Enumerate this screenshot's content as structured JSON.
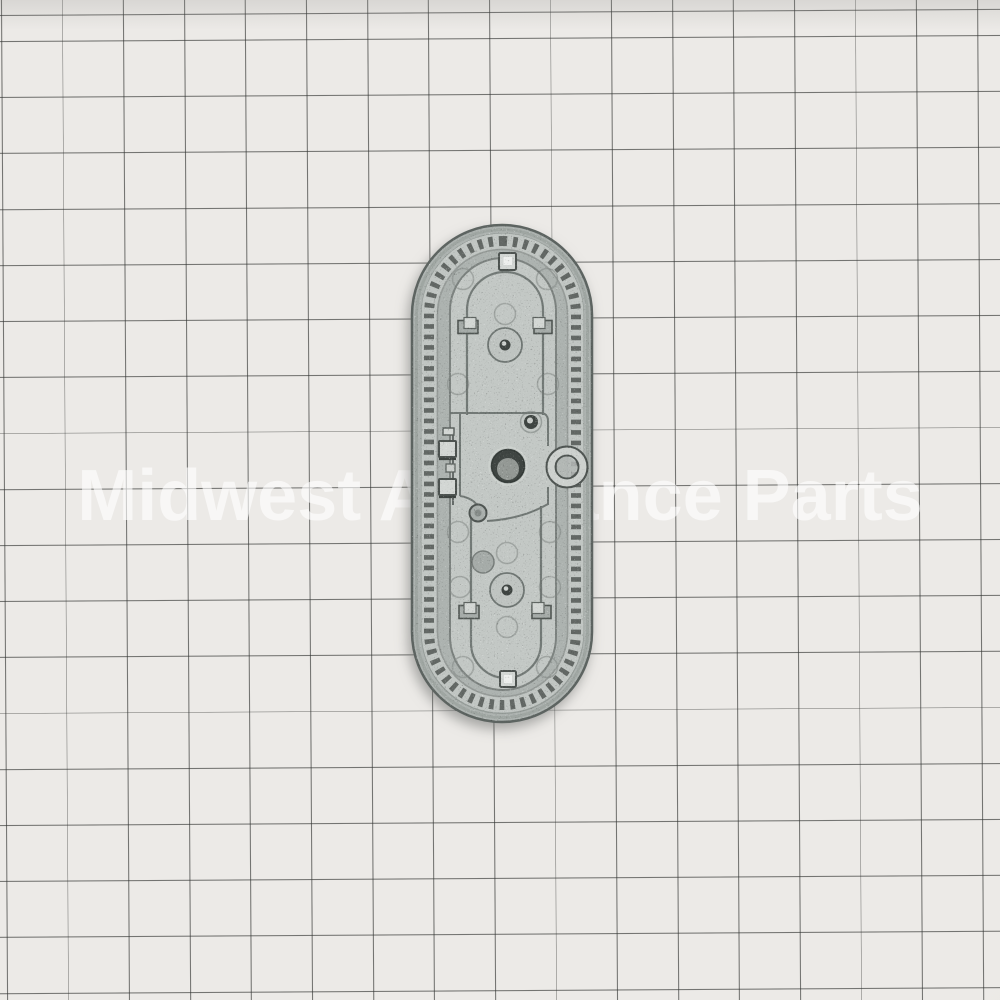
{
  "scene": {
    "kind": "product photo",
    "subject": "cast metal oval mounting plate (appliance part), back side with clips, bosses and D-ring",
    "surface_finish": "speckled cast aluminum",
    "background_desc": "white graph paper grid, slightly skewed",
    "shadow": "soft gray drop shadow around lower-left of the part"
  },
  "watermark": {
    "text": "Midwest Appliance Parts"
  },
  "grid": {
    "cell_width_px": 61,
    "cell_height_px": 56,
    "first_vertical_line_x": 4,
    "first_horizontal_line_y": 38
  },
  "theme": {
    "paper": "#eceae7",
    "grid-line": "rgba(52,54,52,0.66)",
    "watermark-color": "rgba(255,255,255,0.62)",
    "metal-base": "#adb3b0",
    "metal-platform": "#c3c8c5",
    "metal-bevel": "#9ba19e",
    "edge-dark": "#5d6461",
    "line-dark": "#6a716e",
    "groove-light": "#c2c7c4",
    "tooth-dark": "#555b58",
    "hole-dark": "#3f4542",
    "tab-light": "#d3d7d4",
    "part-shadow": "rgba(108,110,108,0.55)"
  },
  "part_features": {
    "outer_shape": "vertical stadium/oval 180x497 px",
    "rim": "perforated tooth ring around perimeter",
    "center": "through-hole with raised plateau",
    "attachments": [
      "top square tab",
      "bottom square tab",
      "4 side tabs",
      "2 left spring clips",
      "right D-ring",
      "2 bosses with pin holes"
    ]
  }
}
